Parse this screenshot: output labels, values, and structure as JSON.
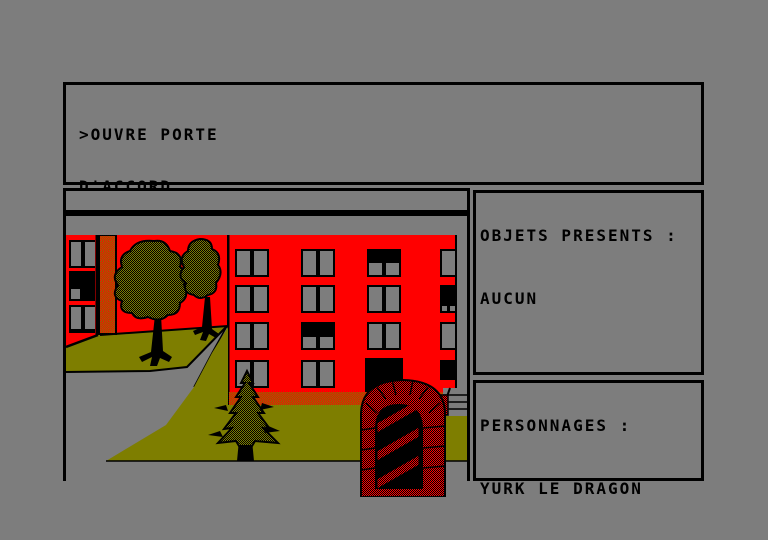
{
  "palette": {
    "background": "#7D7D7D",
    "ink": "#000000",
    "red": "#FF0000",
    "olive": "#7E7E00"
  },
  "terminal": {
    "lines": [
      ">OUVRE PORTE",
      "D'ACCORD",
      ">OUEST",
      "ISSUE(S) PRINCIPALE(S): N,E,O",
      ">?"
    ]
  },
  "scene": {
    "title": "PETITS IMMEUBLES"
  },
  "objects_panel": {
    "title": "OBJETS PRESENTS :",
    "items": [
      "AUCUN"
    ]
  },
  "characters_panel": {
    "title": "PERSONNAGES :",
    "items": [
      "YURK LE DRAGON"
    ]
  }
}
